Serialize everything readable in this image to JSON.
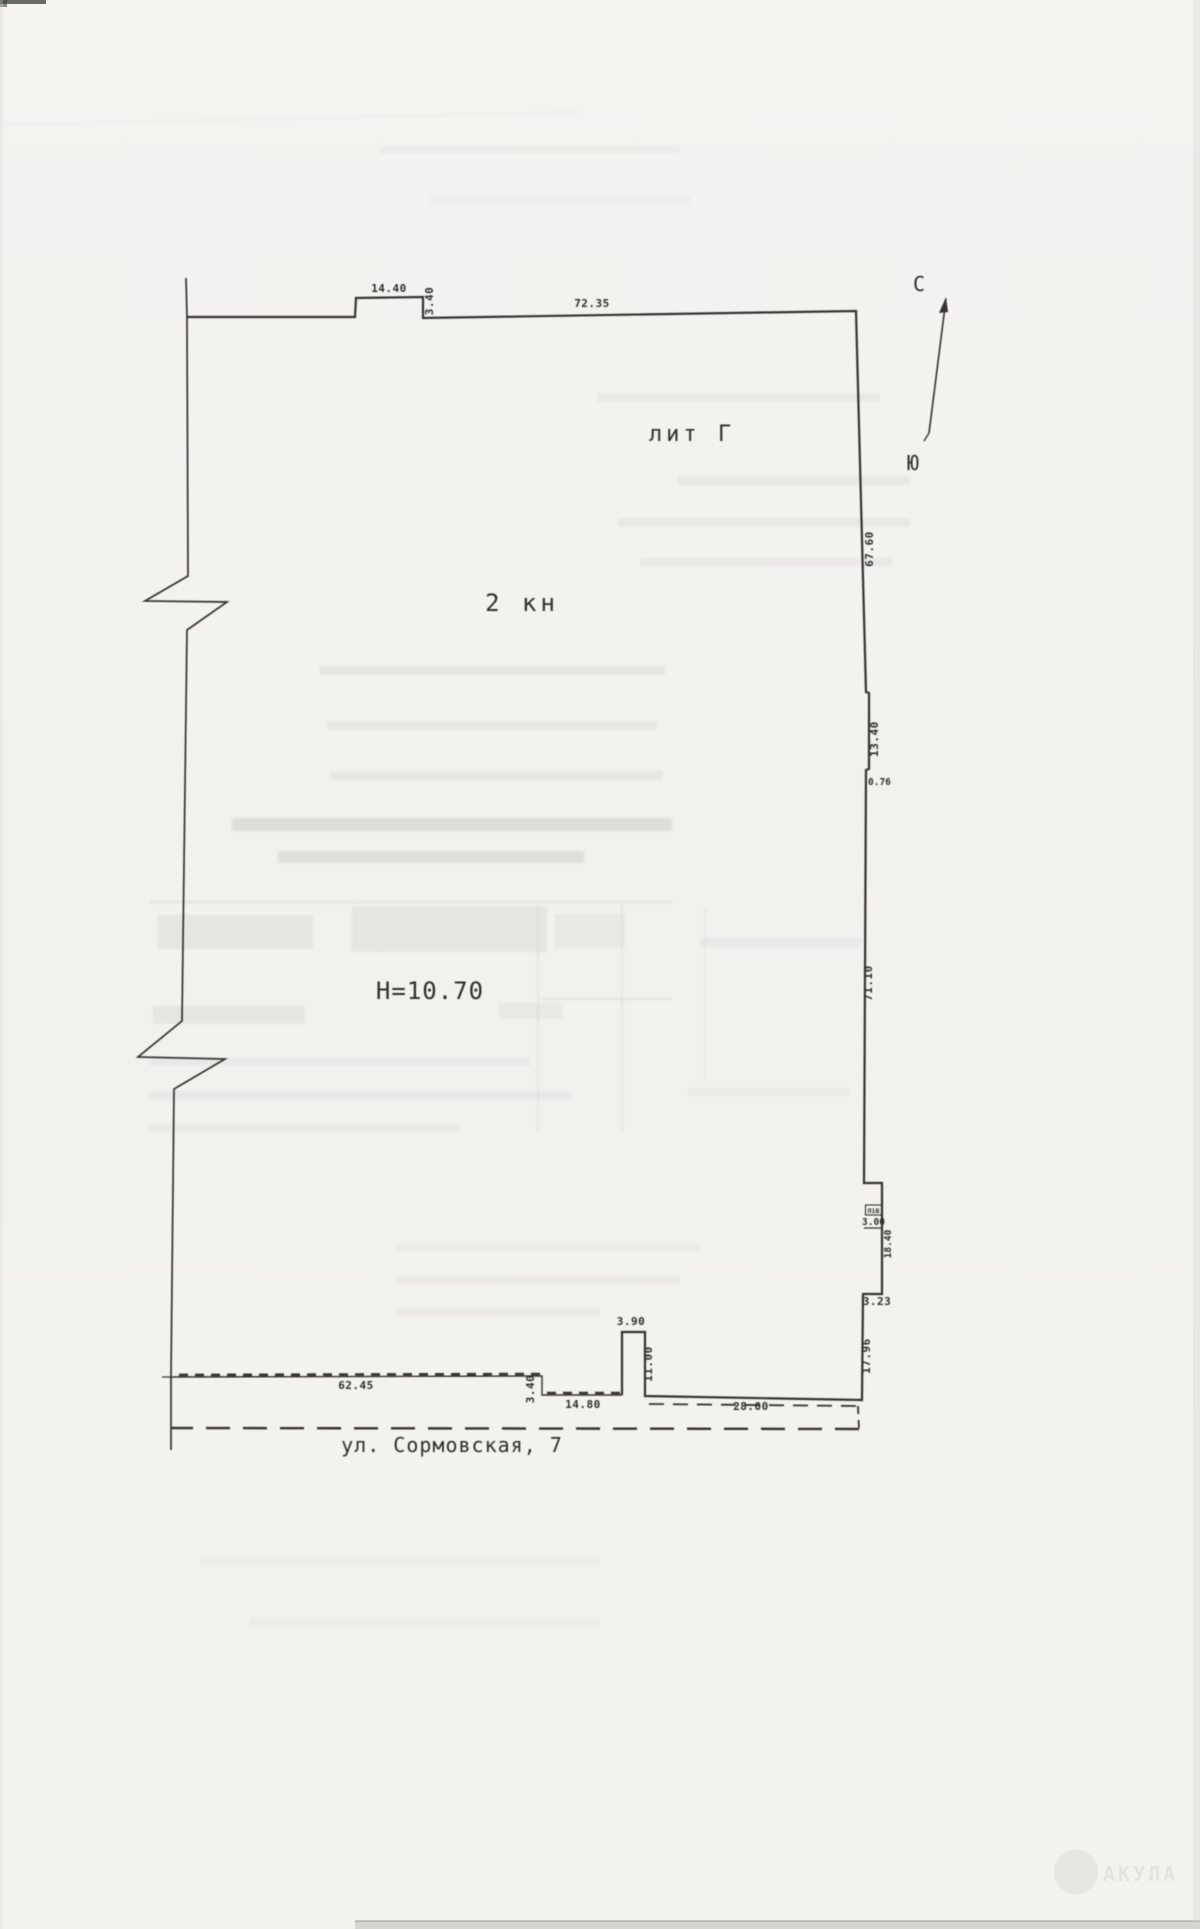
{
  "labels": {
    "building": "лит Г",
    "unit": "2 кн",
    "height": "Н=10.70",
    "street": "ул. Сормовская, 7",
    "niche": "П1В"
  },
  "compass": {
    "north": "С",
    "south": "Ю"
  },
  "dimensions": {
    "top_offset_width": "14.40",
    "top_offset_depth": "3.40",
    "top_main": "72.35",
    "east_upper": "67.60",
    "east_recess": "13.40",
    "east_step": "0.76",
    "east_main": "71.10",
    "niche_width": "3.00",
    "niche_length": "18.40",
    "east_below_niche": "3.23",
    "east_lower": "17.96",
    "south_dashed": "28.00",
    "stub_width": "3.90",
    "stub_height": "11.00",
    "south_step": "3.40",
    "south_mid": "14.80",
    "south_main": "62.45"
  },
  "watermark": {
    "text": "АКУЛА"
  },
  "colors": {
    "paper": "#f3f2ee",
    "ink": "#34322f",
    "ghost": "#6e6d68"
  }
}
